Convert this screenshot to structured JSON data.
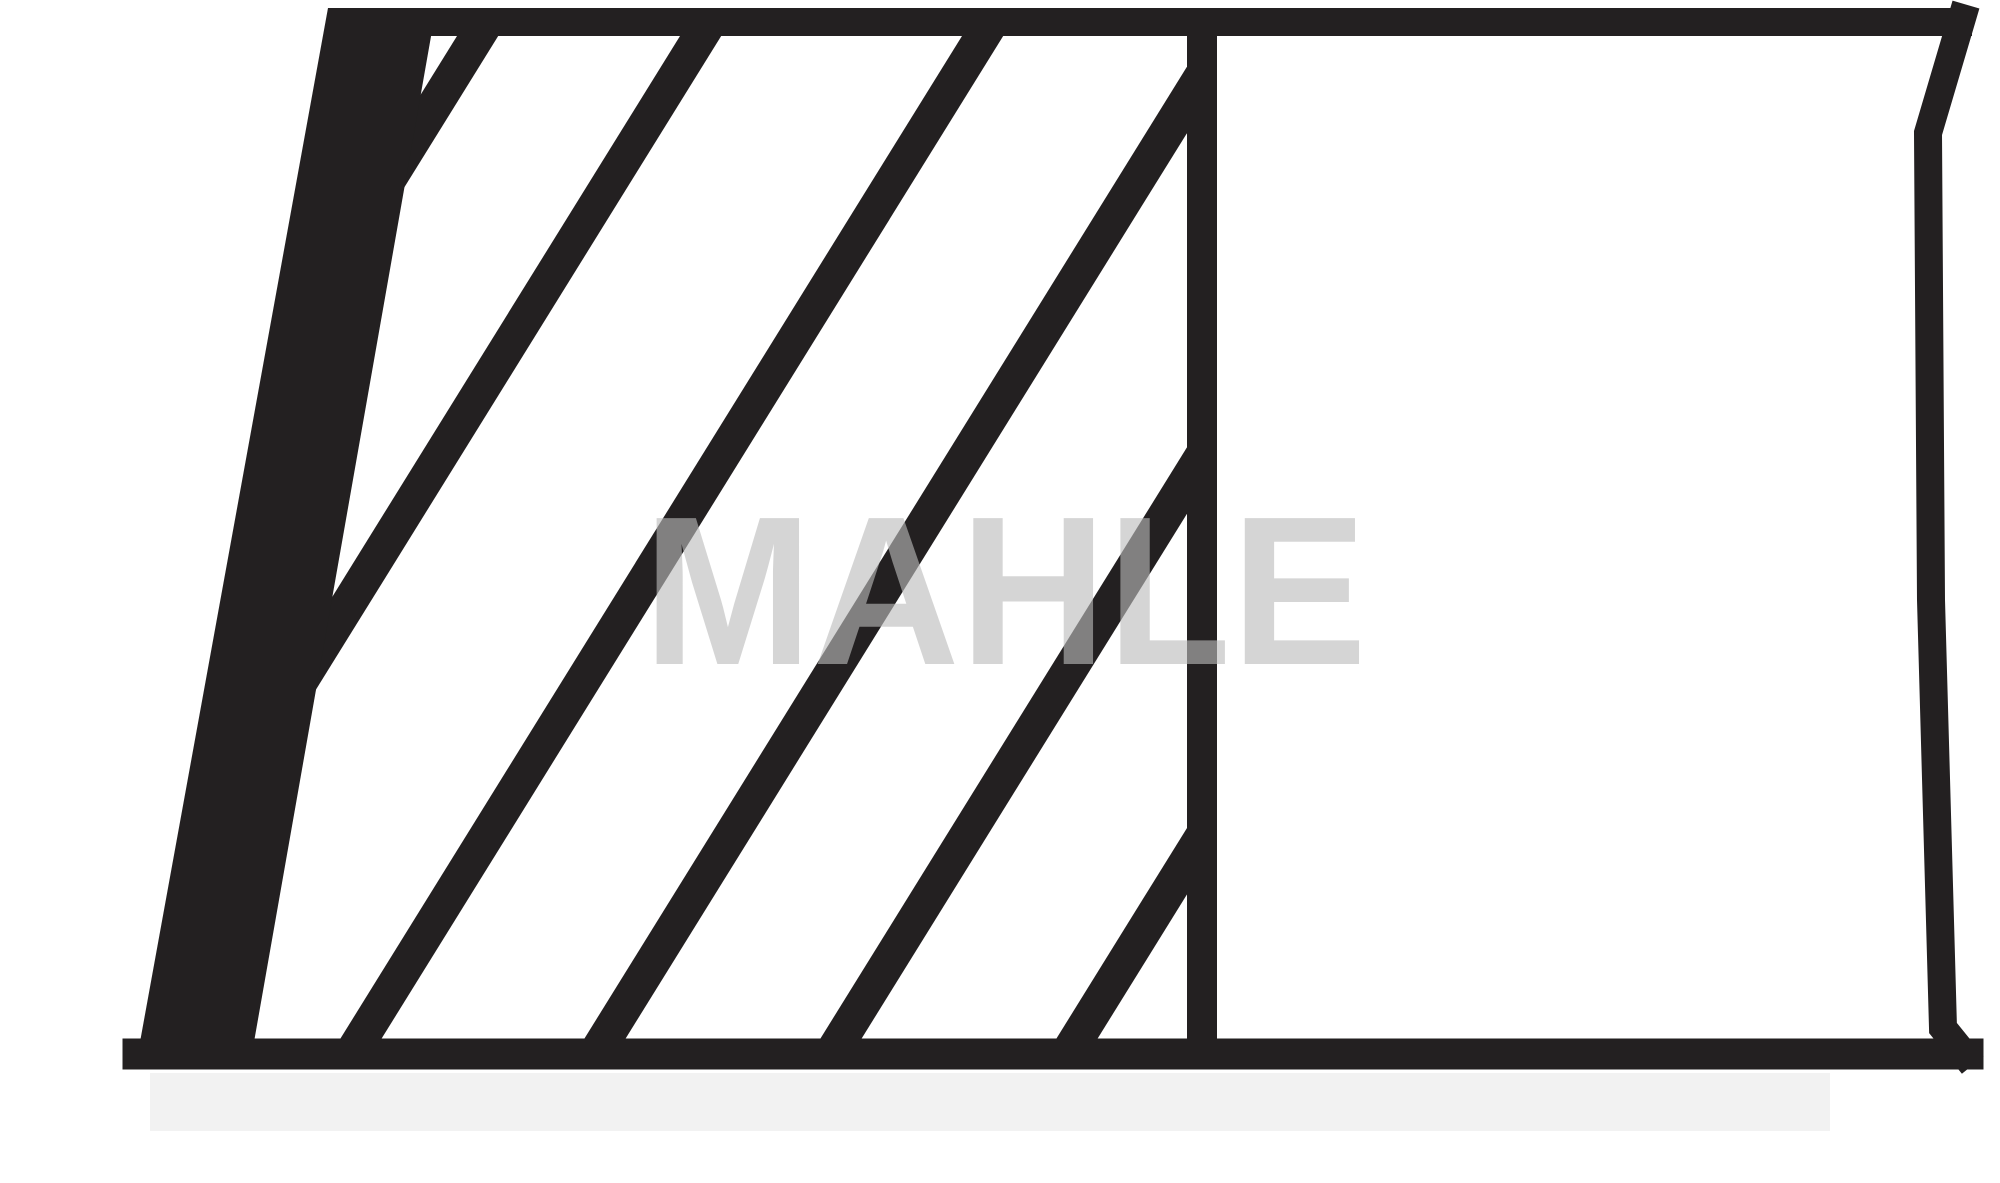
{
  "diagram": {
    "type": "technical-drawing",
    "description": "piston ring cross-section outline with diagonal section hatching, scanned black ink on white",
    "watermark": "MAHLE",
    "colors": {
      "ink": "#232021",
      "background": "#ffffff",
      "watermark": "rgba(187,187,187,0.62)",
      "scan_shadow": "#f2f2f2"
    },
    "canvas": {
      "width": 2000,
      "height": 1183
    },
    "geometry": {
      "wedge_points": "328,8 436,8 254,1042 140,1042",
      "top_bar": {
        "x1": 330,
        "y1": 22,
        "x2": 1972,
        "y2": 22,
        "width": 28
      },
      "right_edge": {
        "points": "1962,18 1928,133 1931,600 1943,1028 1964,1054",
        "width": 28
      },
      "bottom_bar": {
        "x1": 138,
        "y1": 1054,
        "x2": 1968,
        "y2": 1054,
        "width": 31
      },
      "divider": {
        "x1": 1202,
        "y1": 36,
        "x2": 1202,
        "y2": 1040,
        "width": 30
      },
      "hatch": {
        "region_points": "428,36 1187,36 1187,1040 252,1040",
        "anchors_x_top": [
          490,
          713,
          995,
          1239,
          1475,
          1711
        ],
        "y_top": 36,
        "y_bottom": 1040,
        "dx_per_dy": 0.62,
        "width": 35
      },
      "scan_shadow_rect": {
        "x": 150,
        "y": 1073,
        "w": 1680,
        "h": 58
      },
      "watermark_box": {
        "x": 643,
        "baseline": 664,
        "width": 724,
        "font_size": 212
      }
    }
  }
}
